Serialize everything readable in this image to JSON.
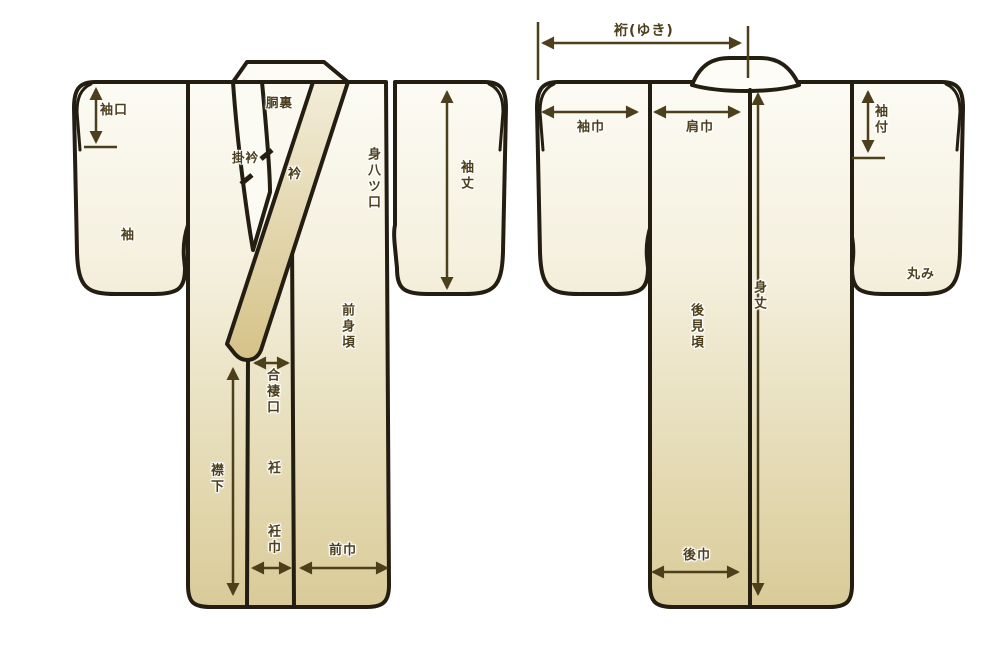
{
  "front_view": {
    "labels": {
      "sodeguchi": "袖口",
      "sode": "袖",
      "doura": "胴裏",
      "kakeeri": "掛衿",
      "eri": "衿",
      "miyatsuguchi": "身八ツ口",
      "sodetake": "袖丈",
      "maemigoro": "前身頃",
      "aizumaguchi": "合褄口",
      "okumi": "衽",
      "erishita": "襟下",
      "okumihaba": "衽巾",
      "maehaba": "前巾"
    }
  },
  "back_view": {
    "labels": {
      "yuki": "裄(ゆき)",
      "sodehaba": "袖巾",
      "katahaba": "肩巾",
      "sodetsuke": "袖付",
      "mitake": "身丈",
      "ushiromigoro": "後見頃",
      "marumi": "丸み",
      "ushirohaba": "後巾"
    }
  },
  "colors": {
    "outline": "#241d11",
    "annotation": "#4c3f1c",
    "fabric_top": "#fcfbf4",
    "fabric_bottom": "#d9cb98",
    "collar_tan": "#d5c288",
    "lining": "#faf8ef"
  }
}
